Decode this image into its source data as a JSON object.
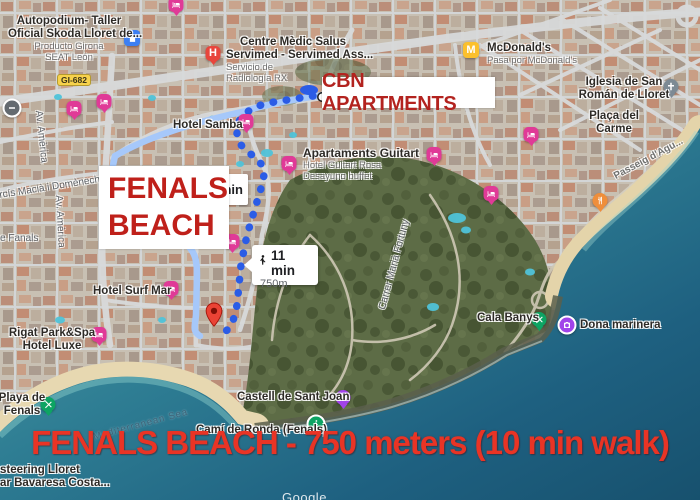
{
  "banner": {
    "text": "FENALS BEACH - 750 meters (10 min walk)"
  },
  "callouts": {
    "cbn_label": "CBN APARTMENTS",
    "fenals_line1": "FENALS",
    "fenals_line2": "BEACH"
  },
  "route_bubble": {
    "time": "11 min",
    "distance": "750m"
  },
  "partial_bubble": {
    "text": "min"
  },
  "road_badge": {
    "text": "GI-682"
  },
  "poi_labels": {
    "autopodium": {
      "line1": "Autopodium- Taller",
      "line2": "Oficial Skoda Lloret de...",
      "sub1": "Producto Girona",
      "sub2": "SEAT León"
    },
    "centre_medic": {
      "line1": "Centre Mèdic Salus",
      "line2": "Servimed - Servimed Ass...",
      "sub1": "Servicio de",
      "sub2": "Radiología RX"
    },
    "mcdonalds": {
      "line1": "McDonald's",
      "sub1": "Pasa por McDonald's"
    },
    "iglesia": {
      "line1": "Iglesia de San",
      "line2": "Román de Lloret"
    },
    "placa_carme": {
      "line1": "Plaça del",
      "line2": "Carme"
    },
    "hotel_samba": {
      "line1": "Hotel Samba"
    },
    "guitart": {
      "line1": "Apartaments Guitart",
      "sub1": "Hotel Guitart Rosa",
      "sub2": "Desayuno buffet"
    },
    "hotel_surf_mar": {
      "line1": "Hotel Surf Mar"
    },
    "rigat": {
      "line1": "Rigat Park&Spa",
      "line2": "Hotel Luxe"
    },
    "playa_fenals": {
      "line1": "Playa de",
      "line2": "Fenals"
    },
    "steering": {
      "line1": "steering Lloret",
      "line2": "ar Bavaresa Costa..."
    },
    "cami_ronda": {
      "line1": "Camí de Ronda (Fenals)"
    },
    "castell": {
      "line1": "Castell de Sant Joan"
    },
    "cala_banys": {
      "line1": "Cala Banys"
    },
    "dona_marinera": {
      "line1": "Dona marinera"
    }
  },
  "street_labels": {
    "passeig": "Passeig d'Agu...",
    "carrer_fortuny": "Carrer Marià Fortuny",
    "av_america_1": "Av. Amèrica",
    "av_america_2": "Av. Amèrica",
    "domenech": "Narcís Macià i Domènech",
    "fanals_street": "e Fanals",
    "mediterranean": "Mediterranean Sea"
  },
  "icon_glyphs": {
    "hospital": "H",
    "mcdonalds": "M"
  },
  "watermark": "Google",
  "colors": {
    "banner_red": "#e93425",
    "callout_red": "#b3231f",
    "route_dot_blue": "#2b5ce6",
    "route_road_blue": "#a6c8fa",
    "lodging_pink": "#e03a97",
    "sea_deep": "#1c5878"
  }
}
